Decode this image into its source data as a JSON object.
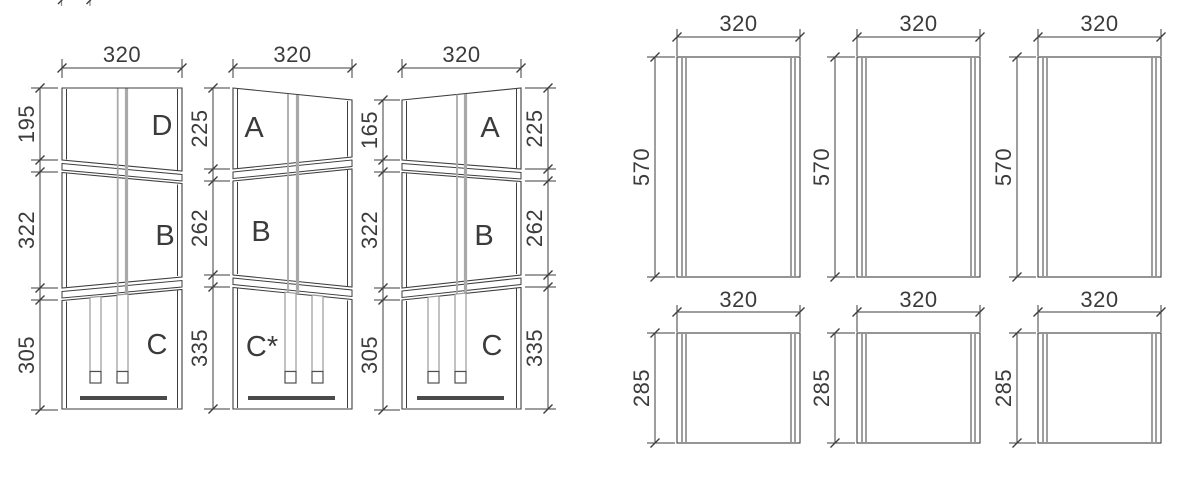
{
  "left_group": {
    "columns": [
      {
        "top_width": "320",
        "left_dims": [
          "195",
          "322",
          "305"
        ],
        "panel_labels": [
          "D",
          "B",
          "C"
        ]
      },
      {
        "top_width": "320",
        "left_dims": [
          "225",
          "262",
          "335"
        ],
        "panel_labels": [
          "A",
          "B",
          "C*"
        ]
      },
      {
        "top_width": "320",
        "left_dims": [
          "165",
          "322",
          "305"
        ],
        "right_dims": [
          "225",
          "262",
          "335"
        ],
        "panel_labels": [
          "A",
          "B",
          "C"
        ]
      }
    ]
  },
  "right_group": {
    "panels": [
      {
        "width": "320",
        "height": "570"
      },
      {
        "width": "320",
        "height": "570"
      },
      {
        "width": "320",
        "height": "570"
      },
      {
        "width": "320",
        "height": "285"
      },
      {
        "width": "320",
        "height": "285"
      },
      {
        "width": "320",
        "height": "285"
      }
    ]
  },
  "colors": {
    "line": "#3e3e3e",
    "text": "#3b3b3b",
    "hidden_line": "#a9a9a9",
    "accent_bar": "#4a4a4a"
  }
}
